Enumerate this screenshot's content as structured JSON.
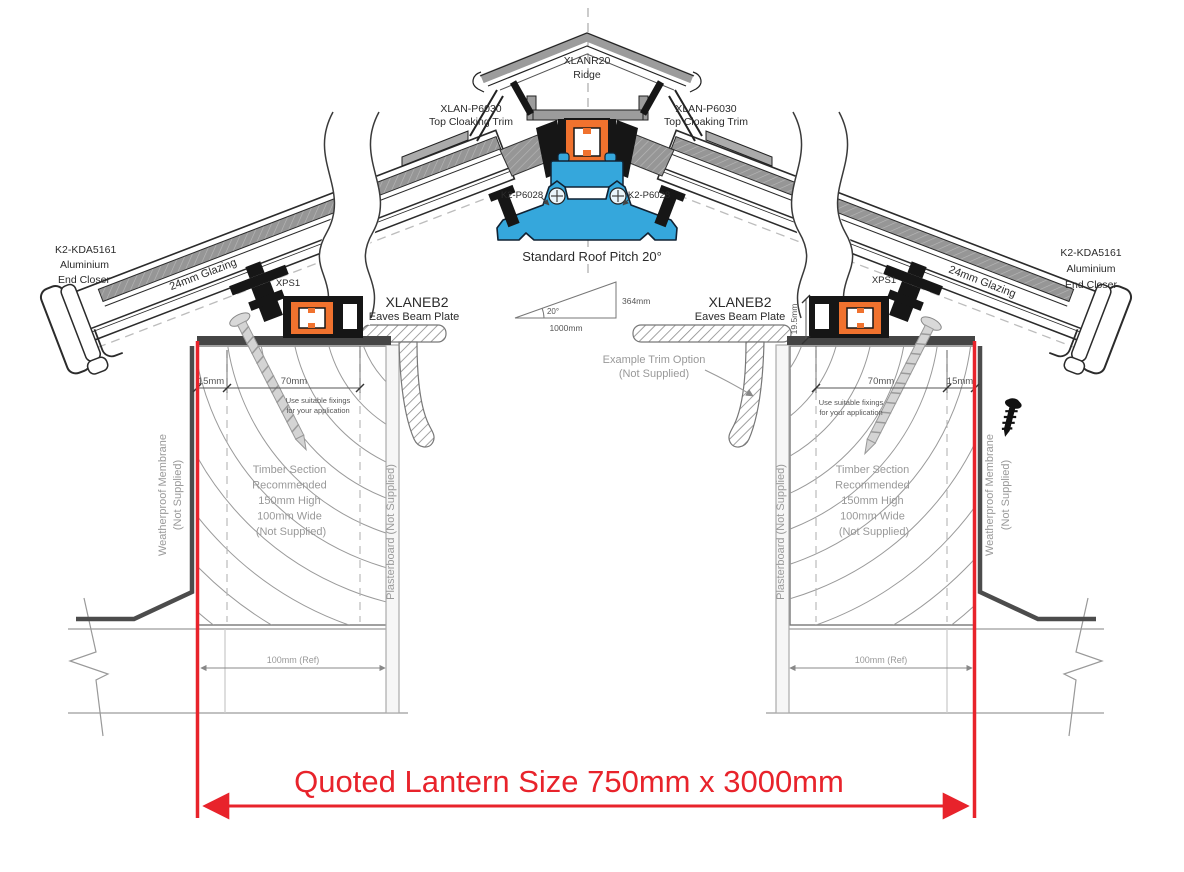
{
  "ridge": {
    "part": "XLANR20",
    "name": "Ridge"
  },
  "top_cloaking_trim": {
    "part": "XLAN-P6030",
    "name": "Top Cloaking Trim"
  },
  "glazing_bar": {
    "part": "K2-P6028"
  },
  "roof_pitch": {
    "label": "Standard Roof Pitch 20°",
    "angle": "20°",
    "base": "1000mm",
    "rise": "364mm"
  },
  "end_closer": {
    "lines": [
      "K2-KDA5161",
      "Aluminium",
      "End Closer"
    ]
  },
  "glazing": {
    "label": "24mm Glazing"
  },
  "thermal_spacer": {
    "label": "XPS1"
  },
  "eaves_beam": {
    "part": "XLANEB2",
    "name": "Eaves Beam Plate"
  },
  "trim_option": {
    "line1": "Example  Trim Option",
    "line2": "(Not Supplied)"
  },
  "dimensions": {
    "edge": "15mm",
    "fixing_zone": "70mm",
    "beam_height": "19.5mm",
    "wall_ref": "100mm (Ref)"
  },
  "fixing_note": {
    "line1": "Use suitable fixings",
    "line2": "for your application"
  },
  "timber_note": {
    "lines": [
      "Timber Section",
      "Recommended",
      "150mm High",
      "100mm Wide",
      "(Not Supplied)"
    ]
  },
  "membrane_note": {
    "line1": "Weatherproof Membrane",
    "line2": "(Not Supplied)"
  },
  "plasterboard_note": {
    "label": "Plasterboard (Not Supplied)"
  },
  "quote": {
    "label": "Quoted Lantern Size 750mm x 3000mm"
  },
  "colors": {
    "accent_red": "#e8232b",
    "profile_orange": "#f0722e",
    "profile_blue": "#35a7dc",
    "aluminium_gray": "#9c9c9c",
    "annotation_gray": "#999999"
  }
}
